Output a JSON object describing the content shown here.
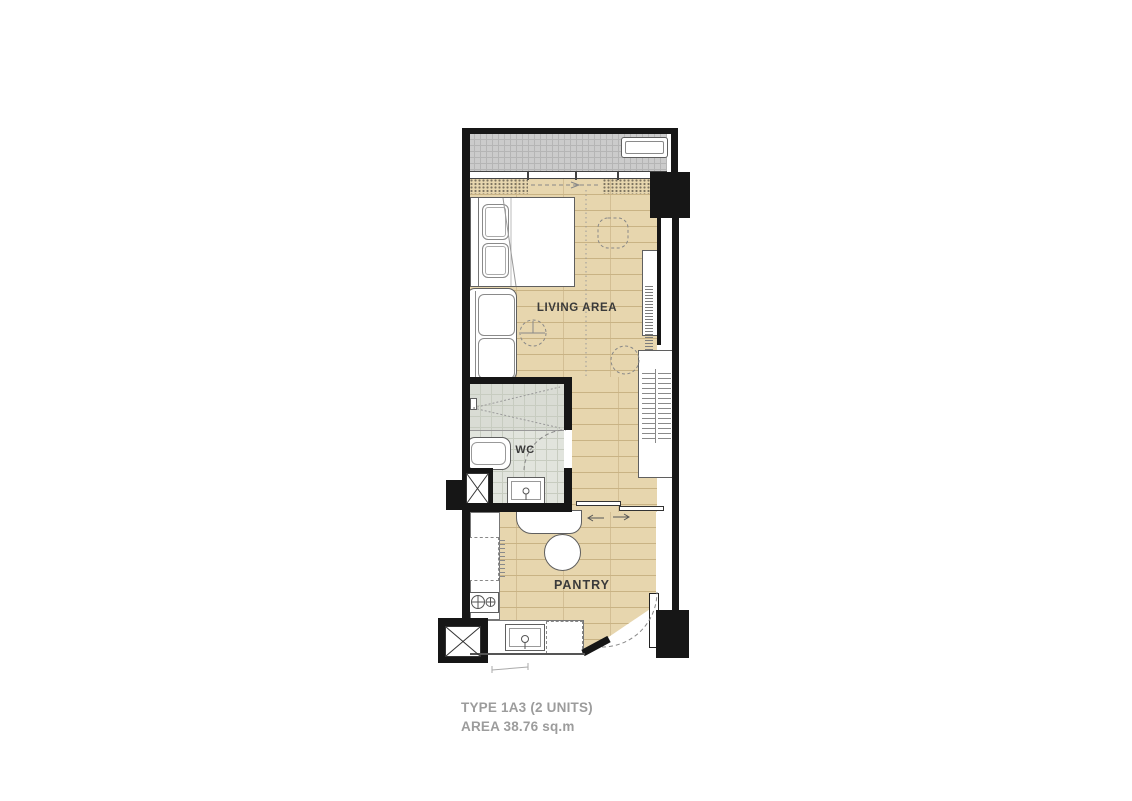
{
  "plan": {
    "type_title": "TYPE 1A3 (2 UNITS)",
    "area_title": "AREA 38.76 sq.m",
    "rooms": {
      "living": {
        "label": "LIVING AREA"
      },
      "wc": {
        "label": "WC"
      },
      "pantry": {
        "label": "PANTRY"
      }
    },
    "features": [
      "balcony with air-conditioner unit",
      "sliding glass door to balcony",
      "bed with two pillows",
      "sofa",
      "side-table",
      "armchair",
      "console desk with hanger rail",
      "shelved wardrobe",
      "shower with glass screen",
      "bathtub-vanity",
      "wc-sink",
      "wc door",
      "refrigerator",
      "two-burner stove",
      "dining bench",
      "round table",
      "kitchen sink",
      "washer position",
      "entrance door",
      "service shafts"
    ]
  },
  "colors": {
    "wall": "#161616",
    "floor_wood": "#e7d6ae",
    "floor_wood_line": "#c9b384",
    "balcony_tile": "#cbcbcb",
    "balcony_line": "#b5b5b5",
    "wc_tile": "#e1e4dd",
    "wc_line": "#c7ccc0",
    "shower_tile": "#d9dcd4",
    "outline": "#5f5f5f",
    "dashed": "#888888",
    "label": "#3a3a3a",
    "title": "#9c9c9c",
    "stipple": "#6a6353"
  }
}
